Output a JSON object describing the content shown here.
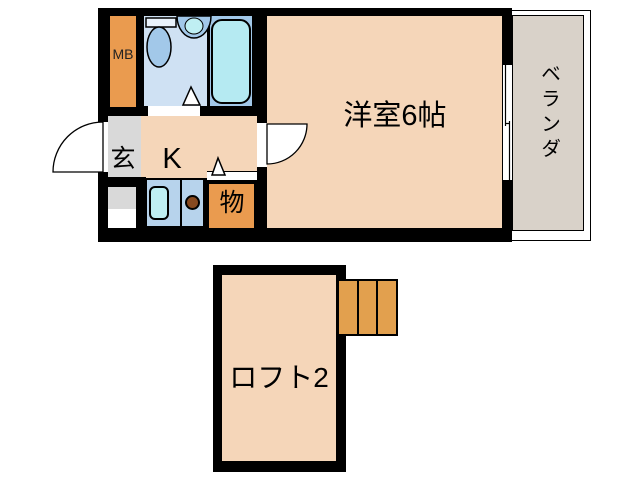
{
  "floorplan": {
    "rooms": {
      "main_room": "洋室6帖",
      "kitchen": "K",
      "entrance": "玄",
      "storage": "物",
      "meter_box": "MB",
      "veranda": "ベランダ",
      "loft": "ロフト2"
    }
  },
  "colors": {
    "wall": "#000000",
    "room-peach": "#f5d6b9",
    "orange": "#ea9b4f",
    "ladder-orange": "#e2a04e",
    "gray": "#d9d9d9",
    "veranda-gray": "#d9d2c9",
    "bath-blue": "#cfe1f3",
    "fixture-blue": "#a2c8e9",
    "tub-cyan": "#b5eaf2",
    "counter-blue": "#b7d3ec",
    "sink-cyan": "#bfeff3",
    "burner-brown": "#87491f"
  }
}
